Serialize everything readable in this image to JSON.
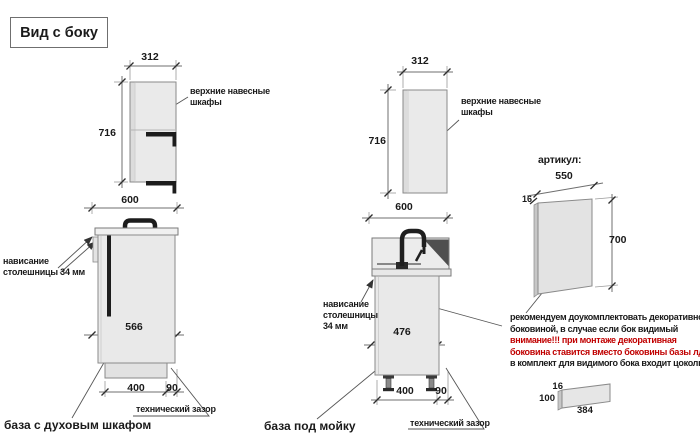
{
  "title": "Вид с боку",
  "colors": {
    "accent_red": "#c00000",
    "cabinet_fill": "#eaeaea",
    "outline": "#8a8a8a",
    "profile_black": "#1c1c1c"
  },
  "left_upper": {
    "dim_width": "312",
    "dim_height": "716",
    "label_line1": "верхние навесные",
    "label_line2": "шкафы"
  },
  "mid_upper": {
    "dim_width": "312",
    "dim_height": "716",
    "label_line1": "верхние навесные",
    "label_line2": "шкафы"
  },
  "left_base": {
    "dim_width": "600",
    "dim_front": "566",
    "dim_a": "400",
    "dim_b": "90",
    "overhang_line1": "нависание",
    "overhang_line2": "столешницы 34 мм",
    "gap_label": "технический зазор",
    "caption": "база с духовым шкафом"
  },
  "mid_base": {
    "dim_width": "600",
    "dim_front": "476",
    "dim_a": "400",
    "dim_b": "90",
    "overhang_line1": "нависание",
    "overhang_line2": "столешницы",
    "overhang_line3": "34 мм",
    "gap_label": "технический зазор",
    "caption": "база под мойку"
  },
  "panel": {
    "heading": "артикул:",
    "dim_width": "550",
    "dim_thickness": "16",
    "dim_height": "700"
  },
  "note": {
    "line1": "рекомендуем доукомплектовать декоративной",
    "line2": "боковиной, в случае если бок видимый",
    "line3": "внимание!!! при монтаже декоративная",
    "line4": "боковина ставится вместо боковины базы лдсп",
    "line5": "в комплект для видимого бока входит цоколь:"
  },
  "plinth": {
    "dim_thickness": "16",
    "dim_height": "100",
    "dim_length": "384"
  }
}
